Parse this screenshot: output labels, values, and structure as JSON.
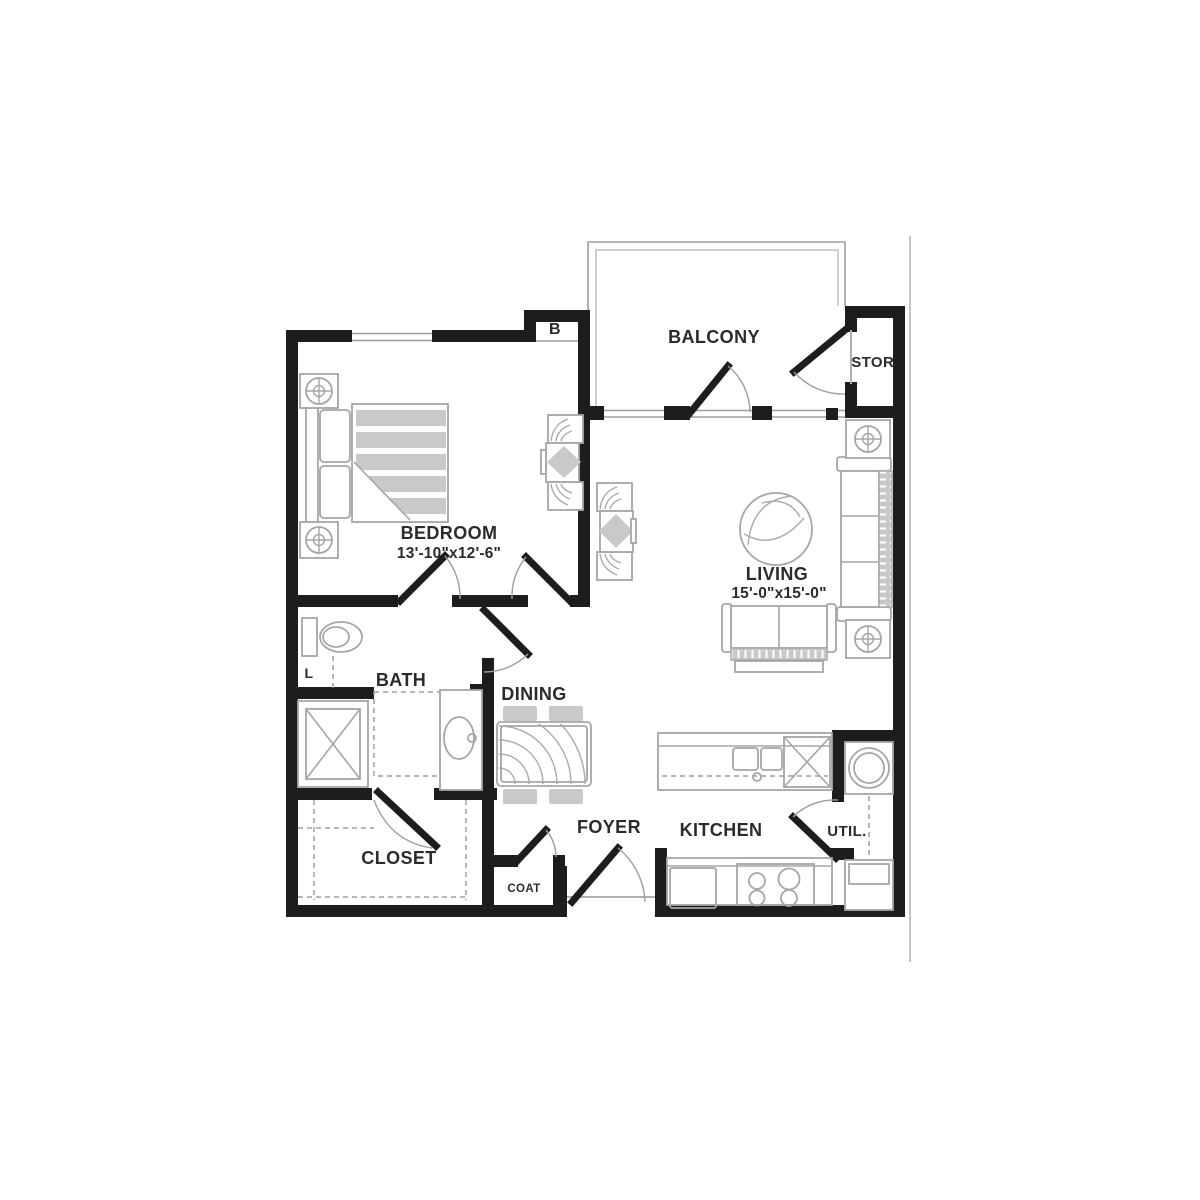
{
  "unit": {
    "label": "B"
  },
  "rooms": {
    "balcony": {
      "label": "BALCONY"
    },
    "storage": {
      "label": "STOR."
    },
    "bedroom": {
      "label": "BEDROOM",
      "dimensions": "13'-10\"x12'-6\""
    },
    "living": {
      "label": "LIVING",
      "dimensions": "15'-0\"x15'-0\""
    },
    "bath": {
      "label": "BATH"
    },
    "linen": {
      "label": "L"
    },
    "dining": {
      "label": "DINING"
    },
    "closet": {
      "label": "CLOSET"
    },
    "coat": {
      "label": "COAT"
    },
    "foyer": {
      "label": "FOYER"
    },
    "kitchen": {
      "label": "KITCHEN"
    },
    "utility": {
      "label": "UTIL."
    }
  },
  "colors": {
    "wall": "#1d1d1d",
    "furniture_line": "#a6a6a6",
    "furniture_fill": "#c9c9c9",
    "label_text": "#2b2b2b",
    "page_border": "#c2c5c7"
  }
}
